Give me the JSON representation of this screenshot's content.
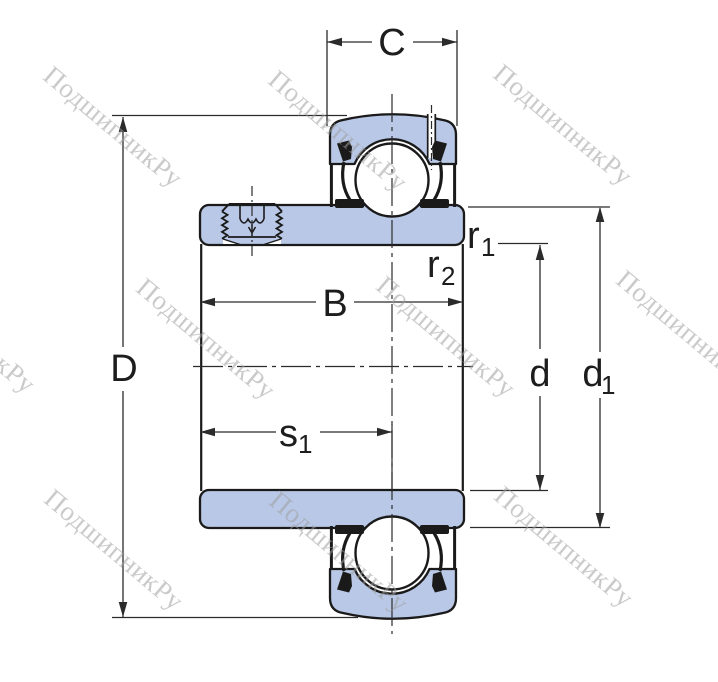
{
  "watermark": {
    "text": "ПодшипникРу"
  },
  "colors": {
    "part_fill": "#b9c8e6",
    "outline": "#1a1a1a",
    "dim_line": "#2b2b2b",
    "watermark": "rgba(158,158,158,0.55)"
  },
  "labels": {
    "C": "C",
    "D": "D",
    "B": "B",
    "d": "d",
    "d1_base": "d",
    "d1_sub": "1",
    "r1_base": "r",
    "r1_sub": "1",
    "r2_base": "r",
    "r2_sub": "2",
    "s1_base": "s",
    "s1_sub": "1"
  }
}
